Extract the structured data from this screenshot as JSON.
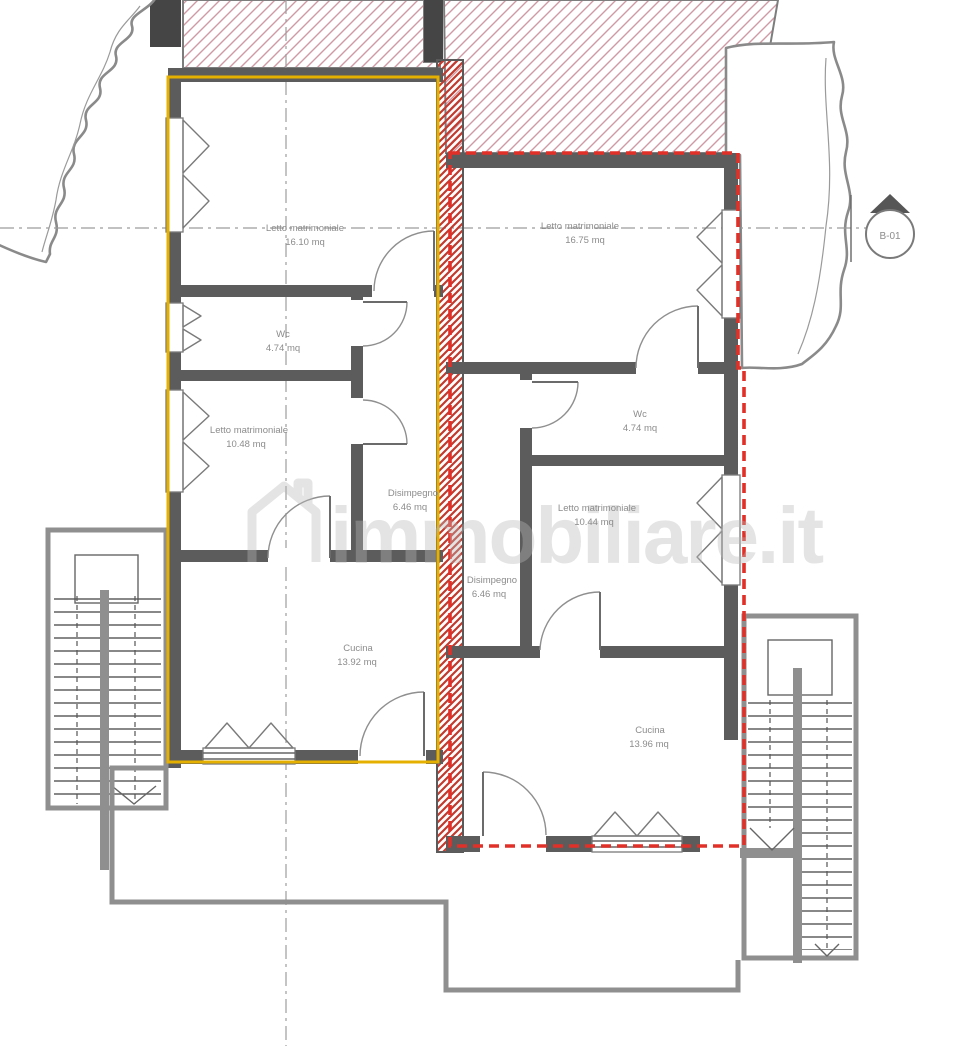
{
  "title": "Floor plan – two apartments",
  "watermark": {
    "text": "immobiliare.it",
    "icon": "house-icon"
  },
  "section_marker": {
    "label": "B-01"
  },
  "apartments": [
    {
      "id": "left-unit",
      "outline_color": "#e6b000",
      "outline_style": "solid",
      "rooms": [
        {
          "name": "Letto matrimoniale",
          "area": "16.10 mq"
        },
        {
          "name": "Wc",
          "area": "4.74 mq"
        },
        {
          "name": "Letto matrimoniale",
          "area": "10.48 mq"
        },
        {
          "name": "Disimpegno",
          "area": "6.46 mq"
        },
        {
          "name": "Cucina",
          "area": "13.92 mq"
        }
      ]
    },
    {
      "id": "right-unit",
      "outline_color": "#e03028",
      "outline_style": "dashed",
      "rooms": [
        {
          "name": "Letto matrimoniale",
          "area": "16.75 mq"
        },
        {
          "name": "Wc",
          "area": "4.74 mq"
        },
        {
          "name": "Letto matrimoniale",
          "area": "10.44 mq"
        },
        {
          "name": "Disimpegno",
          "area": "6.46 mq"
        },
        {
          "name": "Cucina",
          "area": "13.96 mq"
        }
      ]
    }
  ],
  "colors": {
    "wall": "#5c5c5c",
    "wall_dark": "#454545",
    "outline_left": "#e6b000",
    "outline_right": "#e03028",
    "hatch_pink": "#cf9aa5",
    "hatch_red": "#c23a2e",
    "stair_wall": "#8f8f8f",
    "watermark": "#b9b9b9"
  }
}
